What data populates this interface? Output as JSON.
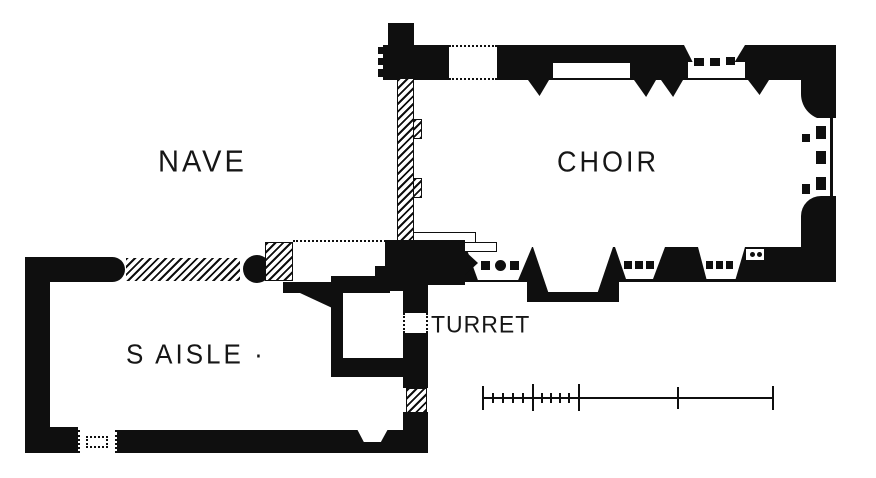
{
  "figure": {
    "kind": "church-ground-plan",
    "colors": {
      "ink": "#0f0f0f",
      "paper": "#ffffff"
    }
  },
  "rooms": {
    "nave": {
      "label": "NAVE"
    },
    "choir": {
      "label": "CHOIR"
    },
    "s_aisle": {
      "label": "S AISLE ·"
    },
    "turret": {
      "label": "TURRET"
    }
  },
  "scale_bar": {
    "major_ticks": 5,
    "minor_ticks": 8,
    "subdivided_sections": 2
  }
}
